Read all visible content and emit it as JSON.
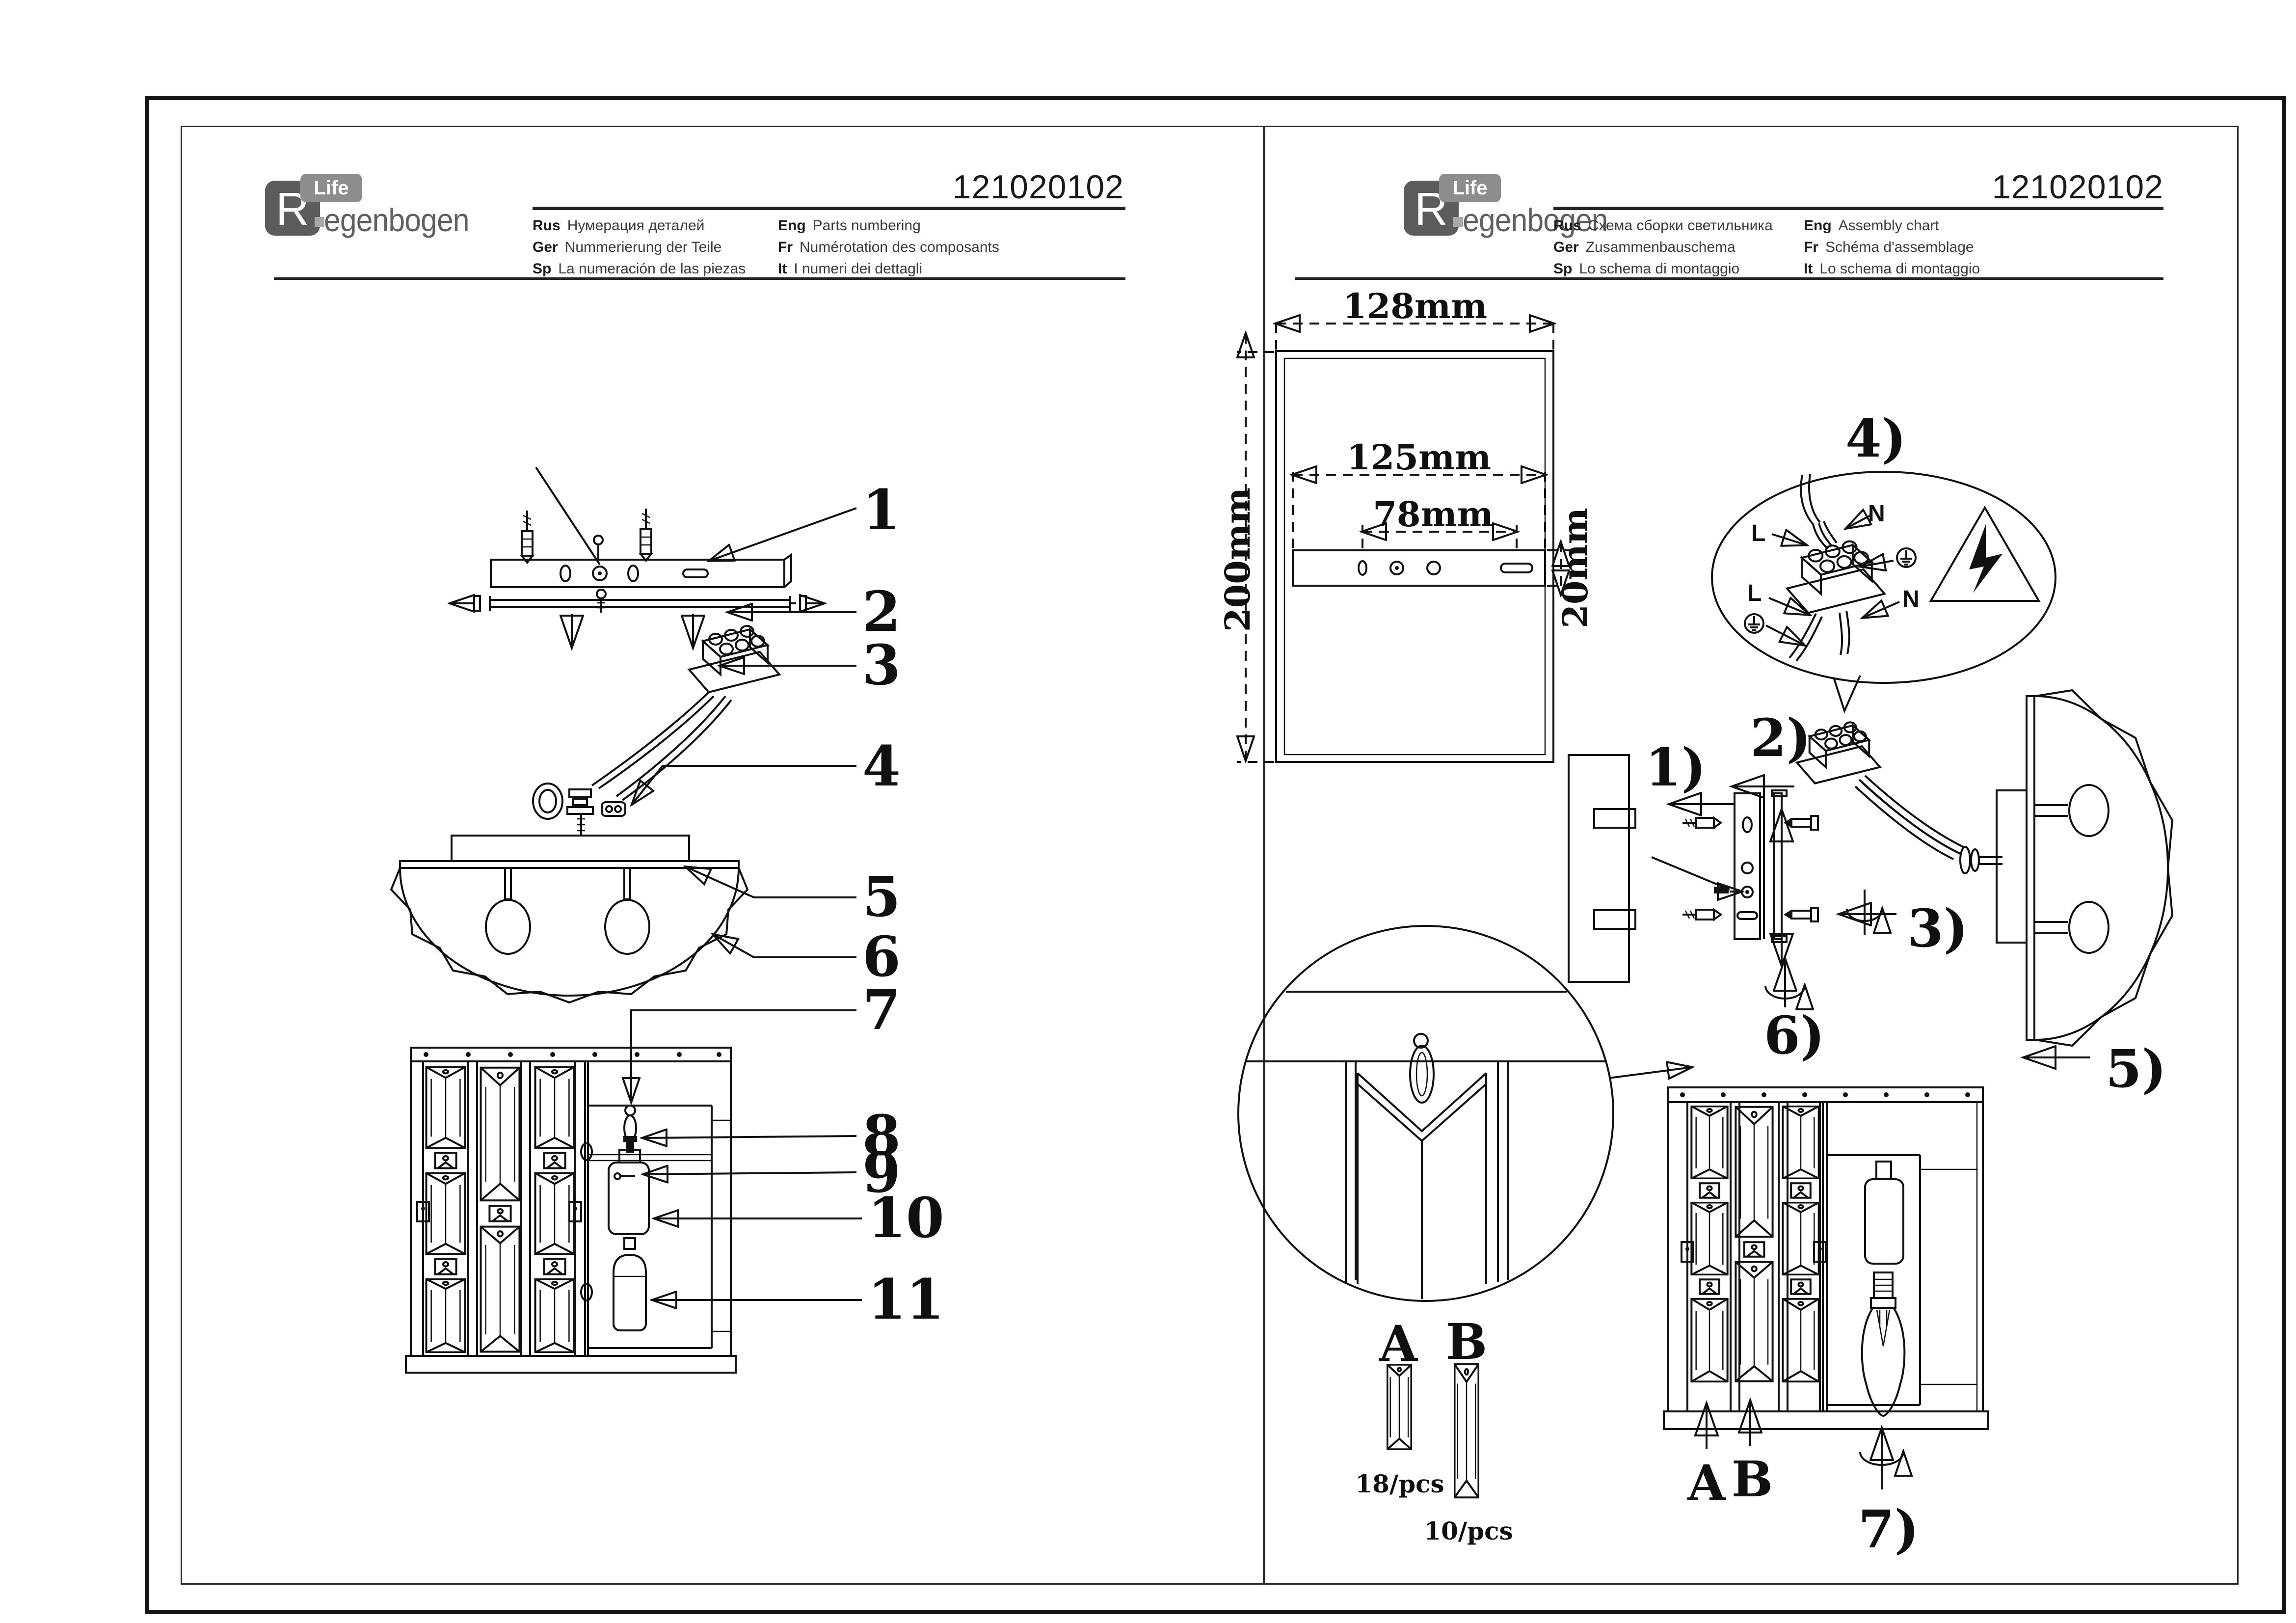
{
  "document": {
    "product_code": "121020102",
    "brand": {
      "initial": "R",
      "life": "Life",
      "wordmark": "egenbogen"
    },
    "left_page": {
      "languages": [
        {
          "code": "Rus",
          "text": "Нумерация деталей"
        },
        {
          "code": "Ger",
          "text": "Nummerierung der Teile"
        },
        {
          "code": "Sp",
          "text": "La numeración de las piezas"
        },
        {
          "code": "Eng",
          "text": "Parts numbering"
        },
        {
          "code": "Fr",
          "text": "Numérotation des composants"
        },
        {
          "code": "It",
          "text": "I numeri dei dettagli"
        }
      ],
      "part_labels": [
        "1",
        "2",
        "3",
        "4",
        "5",
        "6",
        "7",
        "8",
        "9",
        "10",
        "11"
      ]
    },
    "right_page": {
      "languages": [
        {
          "code": "Rus",
          "text": "Схема сборки светильника"
        },
        {
          "code": "Ger",
          "text": "Zusammenbauschema"
        },
        {
          "code": "Sp",
          "text": "Lo schema di montaggio"
        },
        {
          "code": "Eng",
          "text": "Assembly chart"
        },
        {
          "code": "Fr",
          "text": "Schéma d'assemblage"
        },
        {
          "code": "It",
          "text": "Lo schema di montaggio"
        }
      ],
      "steps": [
        "1)",
        "2)",
        "3)",
        "4)",
        "5)",
        "6)",
        "7)"
      ],
      "dimensions": {
        "width": "128mm",
        "bracket_width": "125mm",
        "hole_spacing": "78mm",
        "height": "200mm",
        "bar_height": "20mm"
      },
      "wiring": {
        "live_top": "L",
        "neutral_top": "N",
        "live_bottom": "L",
        "neutral_bottom": "N"
      },
      "crystal_kit": {
        "type_a": "A",
        "type_b": "B",
        "view_a": "A",
        "view_b": "B",
        "count_a": "18/pcs",
        "count_b": "10/pcs"
      }
    }
  }
}
